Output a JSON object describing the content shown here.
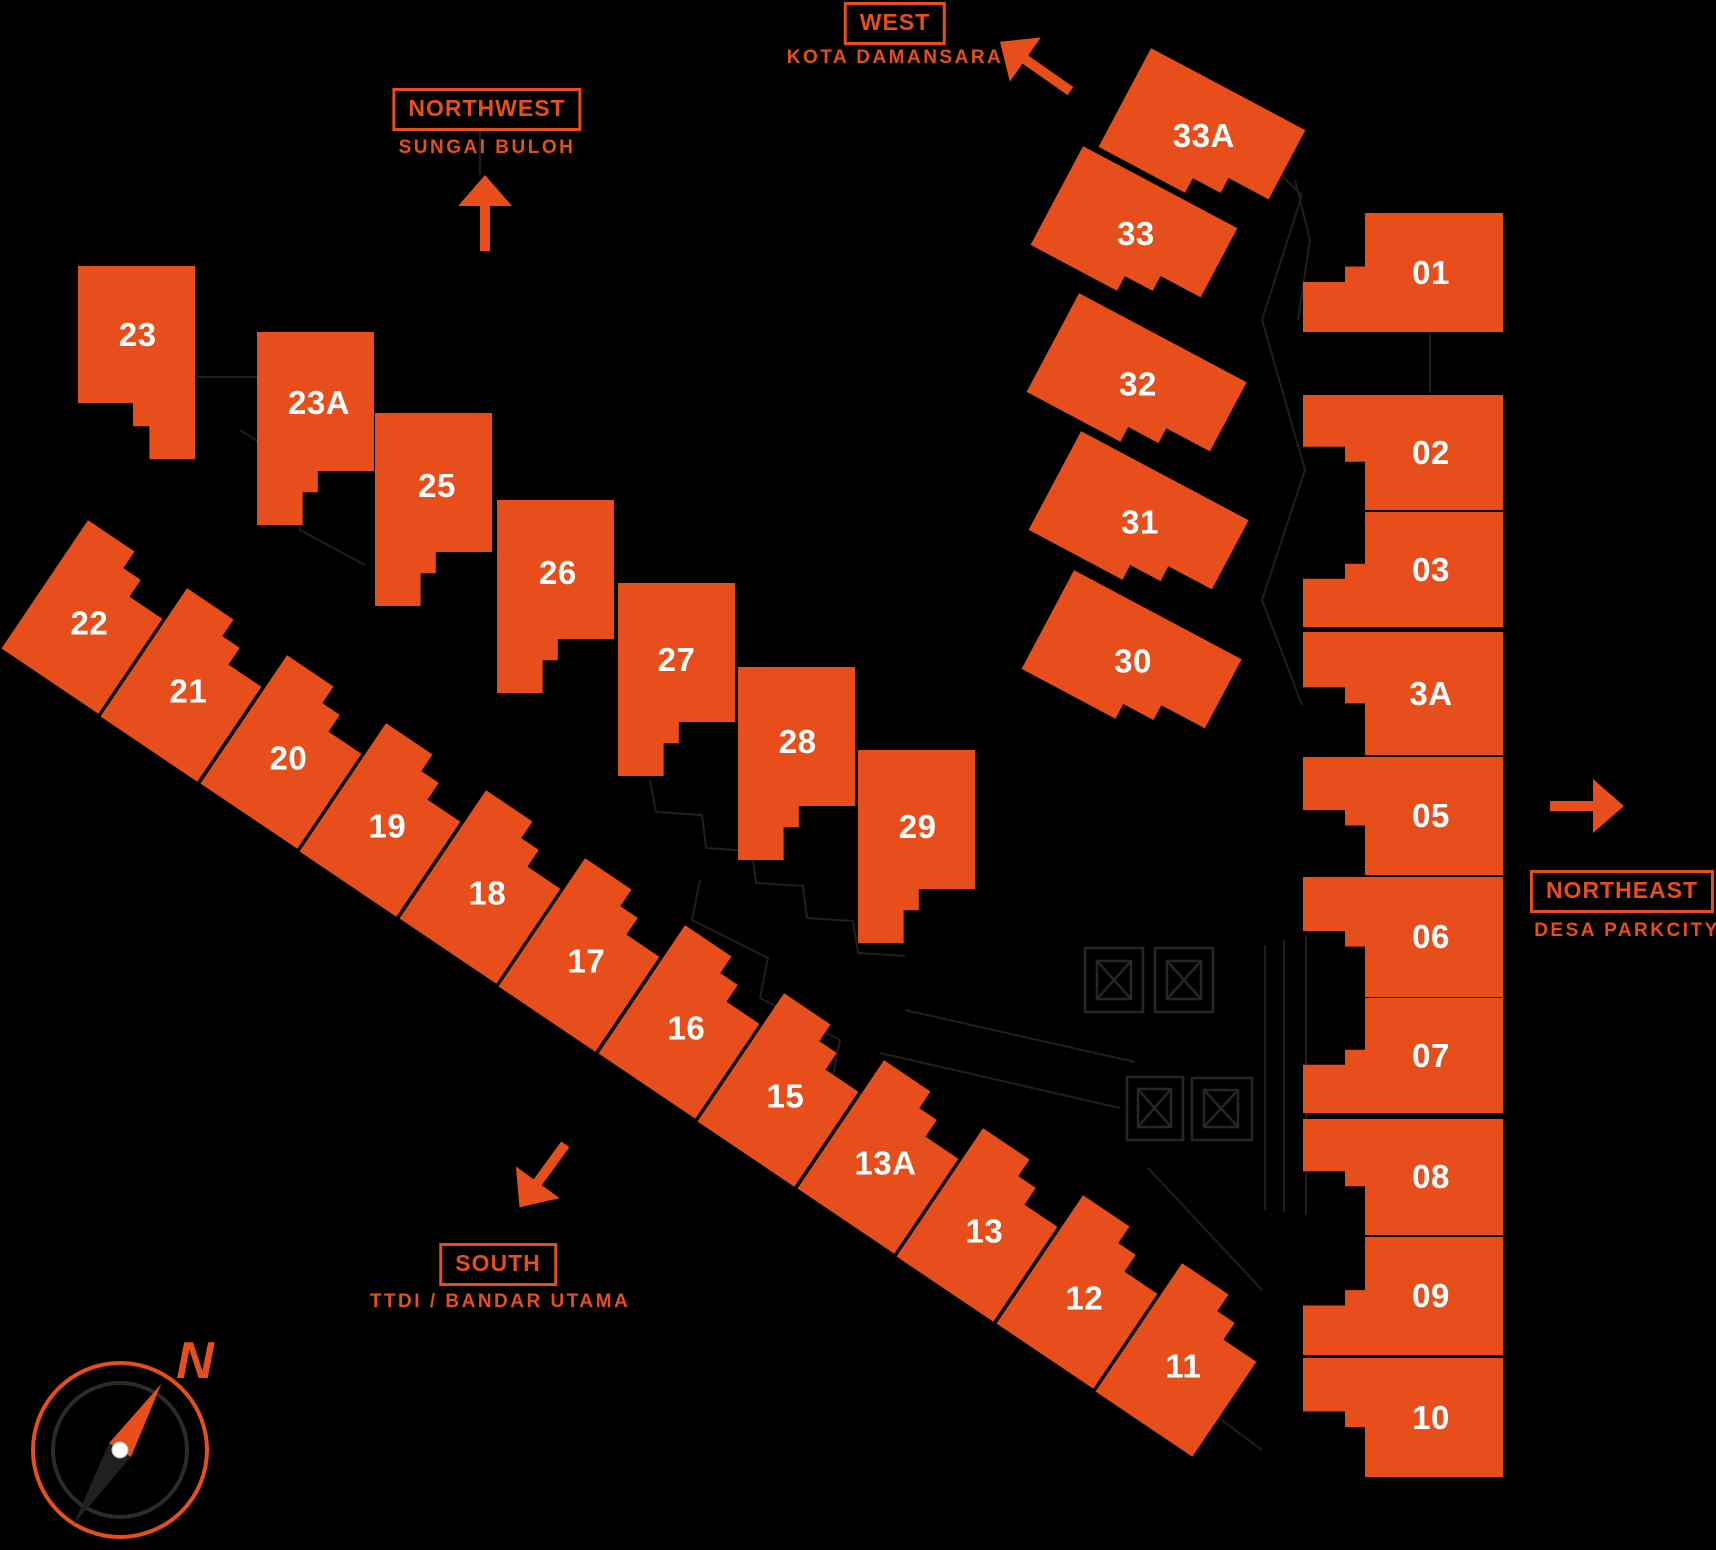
{
  "colors": {
    "orange": "#E84E1B",
    "lot_label": "#FFFFFF",
    "background": "#000000",
    "faint_line": "#1F1F1F",
    "faint_line2": "#262626",
    "compass_inner_ring": "#2B2B2B",
    "compass_needle_dark": "#202020",
    "compass_dot": "#FFFFFF"
  },
  "markers": {
    "northwest": {
      "title": "NORTHWEST",
      "subtitle": "SUNGAI BULOH",
      "arrow_direction": "up"
    },
    "west": {
      "title": "WEST",
      "subtitle": "KOTA DAMANSARA",
      "arrow_direction": "up-left"
    },
    "northeast": {
      "title": "NORTHEAST",
      "subtitle": "DESA PARKCITY",
      "arrow_direction": "right"
    },
    "south": {
      "title": "SOUTH",
      "subtitle": "TTDI / BANDAR UTAMA",
      "arrow_direction": "down-left"
    }
  },
  "compass": {
    "north_label": "N"
  },
  "lots": [
    {
      "label": "23",
      "x": 78,
      "y": 266,
      "w": 117,
      "h": 193,
      "rot": 0,
      "shape": "stepsBL",
      "lx": 0.51,
      "ly": 0.36
    },
    {
      "label": "23A",
      "x": 257,
      "y": 332,
      "w": 117,
      "h": 193,
      "rot": 0,
      "shape": "stepsBR",
      "lx": 0.53,
      "ly": 0.37
    },
    {
      "label": "25",
      "x": 375,
      "y": 413,
      "w": 117,
      "h": 193,
      "rot": 0,
      "shape": "stepsBR",
      "lx": 0.53,
      "ly": 0.38
    },
    {
      "label": "26",
      "x": 497,
      "y": 500,
      "w": 117,
      "h": 193,
      "rot": 0,
      "shape": "stepsBR",
      "lx": 0.52,
      "ly": 0.38
    },
    {
      "label": "27",
      "x": 618,
      "y": 583,
      "w": 117,
      "h": 193,
      "rot": 0,
      "shape": "stepsBR",
      "lx": 0.5,
      "ly": 0.4
    },
    {
      "label": "28",
      "x": 738,
      "y": 667,
      "w": 117,
      "h": 193,
      "rot": 0,
      "shape": "stepsBR",
      "lx": 0.51,
      "ly": 0.39
    },
    {
      "label": "29",
      "x": 858,
      "y": 750,
      "w": 117,
      "h": 193,
      "rot": 0,
      "shape": "stepsBR",
      "lx": 0.51,
      "ly": 0.4
    },
    {
      "label": "22",
      "x": 88,
      "y": 520,
      "w": 117,
      "h": 155,
      "rot": 34,
      "shape": "bandTop",
      "lx": 0.5,
      "ly": 0.55
    },
    {
      "label": "21",
      "x": 187,
      "y": 588,
      "w": 117,
      "h": 155,
      "rot": 34,
      "shape": "bandTop",
      "lx": 0.5,
      "ly": 0.55
    },
    {
      "label": "20",
      "x": 287,
      "y": 655,
      "w": 117,
      "h": 155,
      "rot": 34,
      "shape": "bandTop",
      "lx": 0.5,
      "ly": 0.55
    },
    {
      "label": "19",
      "x": 386,
      "y": 723,
      "w": 117,
      "h": 155,
      "rot": 34,
      "shape": "bandTop",
      "lx": 0.5,
      "ly": 0.55
    },
    {
      "label": "18",
      "x": 486,
      "y": 790,
      "w": 117,
      "h": 155,
      "rot": 34,
      "shape": "bandTop",
      "lx": 0.5,
      "ly": 0.55
    },
    {
      "label": "17",
      "x": 585,
      "y": 858,
      "w": 117,
      "h": 155,
      "rot": 34,
      "shape": "bandTop",
      "lx": 0.5,
      "ly": 0.55
    },
    {
      "label": "16",
      "x": 685,
      "y": 925,
      "w": 117,
      "h": 155,
      "rot": 34,
      "shape": "bandTop",
      "lx": 0.5,
      "ly": 0.55
    },
    {
      "label": "15",
      "x": 784,
      "y": 993,
      "w": 117,
      "h": 155,
      "rot": 34,
      "shape": "bandTop",
      "lx": 0.5,
      "ly": 0.55
    },
    {
      "label": "13A",
      "x": 884,
      "y": 1060,
      "w": 117,
      "h": 155,
      "rot": 34,
      "shape": "bandTop",
      "lx": 0.5,
      "ly": 0.55
    },
    {
      "label": "13",
      "x": 983,
      "y": 1128,
      "w": 117,
      "h": 155,
      "rot": 34,
      "shape": "bandTop",
      "lx": 0.5,
      "ly": 0.55
    },
    {
      "label": "12",
      "x": 1083,
      "y": 1195,
      "w": 117,
      "h": 155,
      "rot": 34,
      "shape": "bandTop",
      "lx": 0.5,
      "ly": 0.55
    },
    {
      "label": "11",
      "x": 1182,
      "y": 1263,
      "w": 117,
      "h": 155,
      "rot": 34,
      "shape": "bandTop",
      "lx": 0.5,
      "ly": 0.55
    },
    {
      "label": "33A",
      "x": 1151,
      "y": 48,
      "w": 175,
      "h": 112,
      "rot": 28,
      "shape": "clusterBR",
      "lx": 0.5,
      "ly": 0.47
    },
    {
      "label": "33",
      "x": 1083,
      "y": 146,
      "w": 175,
      "h": 112,
      "rot": 28,
      "shape": "clusterBR",
      "lx": 0.5,
      "ly": 0.47
    },
    {
      "label": "32",
      "x": 1079,
      "y": 293,
      "w": 190,
      "h": 112,
      "rot": 28,
      "shape": "clusterBR",
      "lx": 0.5,
      "ly": 0.47
    },
    {
      "label": "31",
      "x": 1081,
      "y": 431,
      "w": 190,
      "h": 112,
      "rot": 28,
      "shape": "clusterBR",
      "lx": 0.5,
      "ly": 0.47
    },
    {
      "label": "30",
      "x": 1074,
      "y": 570,
      "w": 190,
      "h": 112,
      "rot": 28,
      "shape": "clusterBR",
      "lx": 0.5,
      "ly": 0.47
    },
    {
      "label": "01",
      "x": 1303,
      "y": 213,
      "w": 200,
      "h": 119,
      "rot": 0,
      "shape": "rightA",
      "lx": 0.64,
      "ly": 0.5
    },
    {
      "label": "02",
      "x": 1303,
      "y": 395,
      "w": 200,
      "h": 115,
      "rot": 0,
      "shape": "rightB",
      "lx": 0.64,
      "ly": 0.5
    },
    {
      "label": "03",
      "x": 1303,
      "y": 512,
      "w": 200,
      "h": 115,
      "rot": 0,
      "shape": "rightA",
      "lx": 0.64,
      "ly": 0.5
    },
    {
      "label": "3A",
      "x": 1303,
      "y": 632,
      "w": 200,
      "h": 123,
      "rot": 0,
      "shape": "rightB",
      "lx": 0.64,
      "ly": 0.5
    },
    {
      "label": "05",
      "x": 1303,
      "y": 757,
      "w": 200,
      "h": 118,
      "rot": 0,
      "shape": "rightB",
      "lx": 0.64,
      "ly": 0.5
    },
    {
      "label": "06",
      "x": 1303,
      "y": 877,
      "w": 200,
      "h": 120,
      "rot": 0,
      "shape": "rightB",
      "lx": 0.64,
      "ly": 0.5
    },
    {
      "label": "07",
      "x": 1303,
      "y": 998,
      "w": 200,
      "h": 115,
      "rot": 0,
      "shape": "rightA",
      "lx": 0.64,
      "ly": 0.5
    },
    {
      "label": "08",
      "x": 1303,
      "y": 1119,
      "w": 200,
      "h": 116,
      "rot": 0,
      "shape": "rightB",
      "lx": 0.64,
      "ly": 0.5
    },
    {
      "label": "09",
      "x": 1303,
      "y": 1237,
      "w": 200,
      "h": 118,
      "rot": 0,
      "shape": "rightA",
      "lx": 0.64,
      "ly": 0.5
    },
    {
      "label": "10",
      "x": 1303,
      "y": 1358,
      "w": 200,
      "h": 119,
      "rot": 0,
      "shape": "rightB",
      "lx": 0.64,
      "ly": 0.5
    }
  ]
}
